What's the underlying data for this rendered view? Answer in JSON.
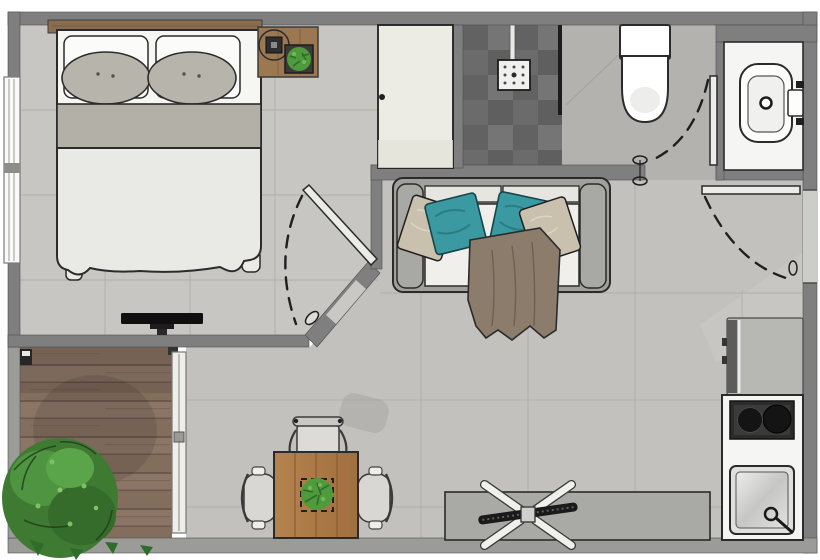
{
  "meta": {
    "type": "floor-plan",
    "view": "top-down 2d rendered plan",
    "text_visible": false
  },
  "palette": {
    "wall": "#7f7f7f",
    "wallLight": "#9b9b97",
    "wallEdge": "#4f4f4f",
    "floorBedroom": "#c7c6c2",
    "floorLiving": "#c2c1bd",
    "floorBath": "#b3b2af",
    "floorEntry": "#c9c8c4",
    "tileLine": "#b1b0ac",
    "showerDark": "#6b6b6b",
    "cream": "#ecece4",
    "counter": "#f5f5f3",
    "white": "#f6f6f3",
    "bedBand": "#b3b0a8",
    "duvet": "#e9e9e5",
    "pillowAccent": "#b7b4ac",
    "sofaFrame": "#a0a09c",
    "cushion": "#f0efeb",
    "teal": "#3a99a1",
    "beige": "#c9c0ae",
    "throw": "#8b7c6b",
    "tableWood": "#ae7b47",
    "nightWood": "#9b7752",
    "headboardWood": "#8a6d4f",
    "plantDark": "#2f6b2a",
    "plant": "#4f9a3d",
    "plantLight": "#72b858",
    "appliance": "#b7b7b4",
    "applianceDark": "#5c5c5c",
    "cooktop": "#2c2c2c",
    "burner": "#141414",
    "sideboard": "#a9a9a5",
    "outline": "#2b2b2b",
    "doorLeaf": "#ebebe7",
    "bg": "#ffffff"
  },
  "rooms": [
    {
      "id": "bedroom",
      "furniture": [
        "double-bed",
        "two-white-pillows",
        "two-gray-accent-pillows",
        "headboard",
        "nightstand",
        "table-lamp",
        "small-potted-plant",
        "wardrobe",
        "wall-tv",
        "window"
      ]
    },
    {
      "id": "shower-room",
      "furniture": [
        "dark-tiled-shower",
        "shower-head",
        "glass-partition"
      ]
    },
    {
      "id": "bathroom",
      "furniture": [
        "toilet",
        "washbasin",
        "vanity-counter",
        "faucet",
        "swing-door"
      ]
    },
    {
      "id": "living-dining",
      "furniture": [
        "sofa",
        "teal-cushions",
        "beige-cushions",
        "throw-blanket",
        "dining-table",
        "three-chairs",
        "table-plant",
        "sideboard",
        "ceiling-fan"
      ]
    },
    {
      "id": "kitchenette",
      "furniture": [
        "fridge",
        "two-burner-cooktop",
        "kitchen-sink",
        "counter"
      ]
    },
    {
      "id": "balcony",
      "furniture": [
        "wood-deck",
        "large-plant",
        "sliding-glass-door"
      ]
    },
    {
      "id": "entry",
      "furniture": [
        "entrance-door",
        "door-swing-arc"
      ]
    }
  ],
  "doors": [
    {
      "id": "entrance-door",
      "wall": "right",
      "state": "open-with-swing-arc"
    },
    {
      "id": "bedroom-door",
      "wall": "diagonal-corner",
      "state": "open-with-swing-arc"
    },
    {
      "id": "bathroom-door",
      "wall": "bathroom-south",
      "state": "open-with-swing-arc"
    },
    {
      "id": "balcony-sliding-door",
      "wall": "balcony-east",
      "state": "closed"
    }
  ]
}
